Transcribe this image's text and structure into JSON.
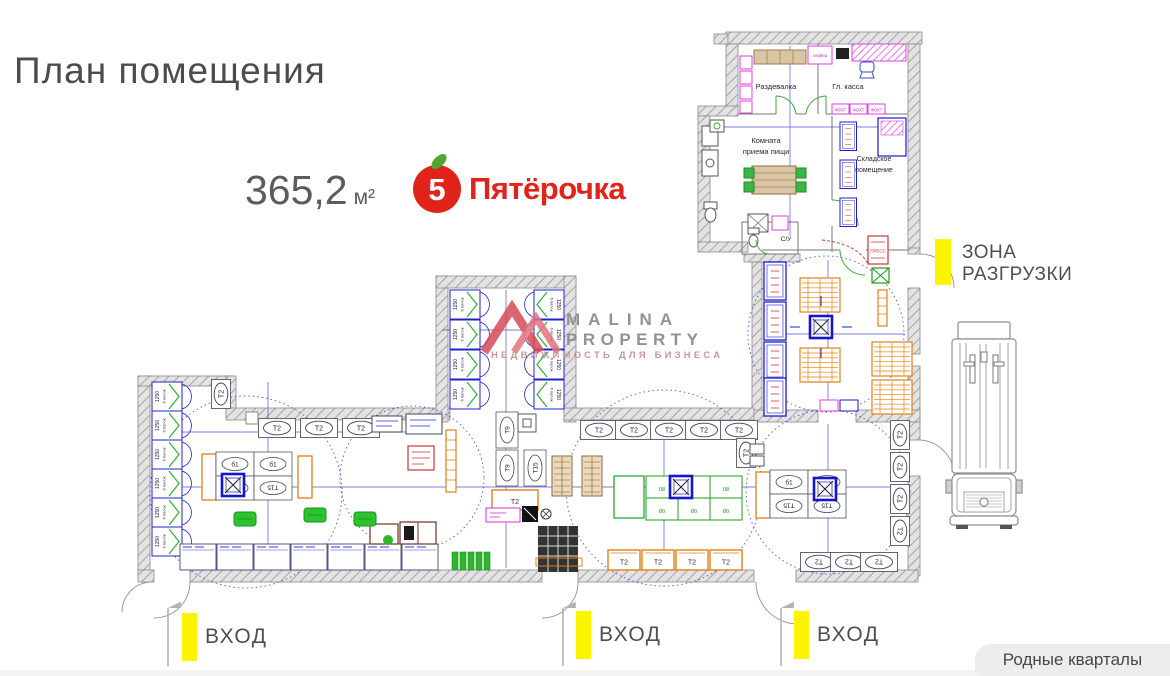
{
  "header": {
    "title": "План помещения",
    "area_value": "365,2",
    "area_unit": "м²"
  },
  "brand": {
    "digit": "5",
    "name": "Пятёрочка",
    "red": "#e2231a",
    "leaf_green": "#4ea82e"
  },
  "watermark": {
    "line1": "MALINA",
    "line2": "PROPERTY",
    "tagline": "НЕДВИЖИМОСТЬ ДЛЯ БИЗНЕСА"
  },
  "annotations": {
    "entrances": [
      {
        "label": "ВХОД"
      },
      {
        "label": "ВХОД"
      },
      {
        "label": "ВХОД"
      }
    ],
    "unloading": {
      "line1": "ЗОНА",
      "line2": "РАЗГРУЗКИ"
    },
    "highlight_color": "#fdf500"
  },
  "footer": {
    "badge": "Родные кварталы"
  },
  "plan": {
    "rooms": {
      "dressing": "Раздевалка",
      "cash": "Гл. касса",
      "server": "сервер",
      "eating1": "Комната",
      "eating2": "приема пищи",
      "storage1": "Складское",
      "storage2": "помещение",
      "wc": "С/У",
      "press": "ПРЕСС"
    },
    "fixtures": {
      "t2": "Т2",
      "t9": "Т9",
      "t15": "Т15",
      "b1": "б1",
      "rack_width": "1250",
      "rack_shelves": "6 полок",
      "island_a": "08",
      "island_b": "80",
      "cashbox": "ФОХТ"
    },
    "colors": {
      "wall_gray": "#a9a9a9",
      "line_blue": "#2222cc",
      "green": "#2fae3a",
      "orange": "#e08018",
      "magenta": "#e03ee0",
      "red": "#cc3333"
    }
  }
}
